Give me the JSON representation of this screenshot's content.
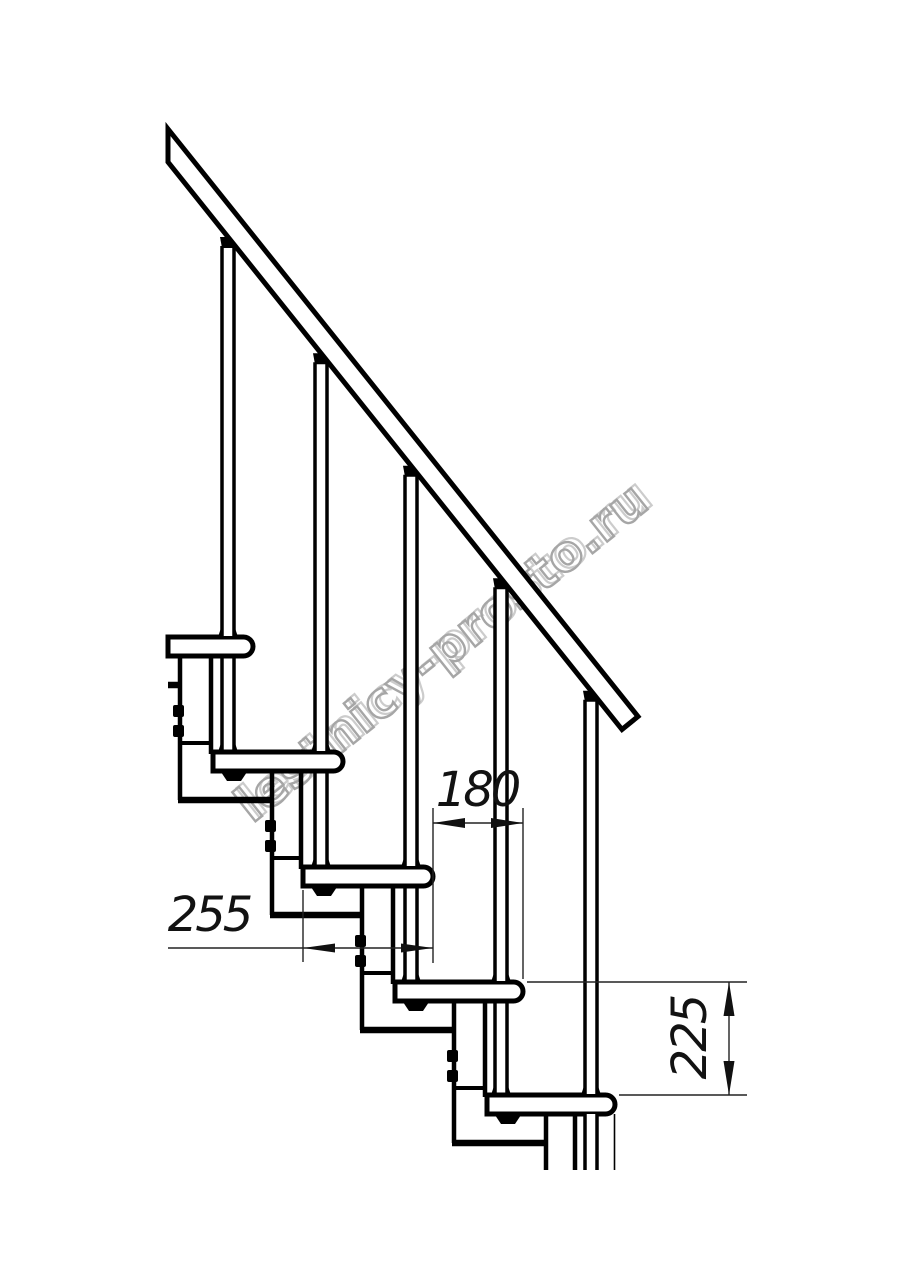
{
  "drawing": {
    "background_color": "#ffffff",
    "line_color": "#000000",
    "steps_visible": 5,
    "balusters_visible": 5
  },
  "dimensions": {
    "going": "180",
    "tread_depth": "255",
    "rise": "225"
  },
  "watermark": {
    "text": "lestnicy-prosto.ru",
    "color": "#a6a6a6",
    "back_color": "#cccccc"
  }
}
